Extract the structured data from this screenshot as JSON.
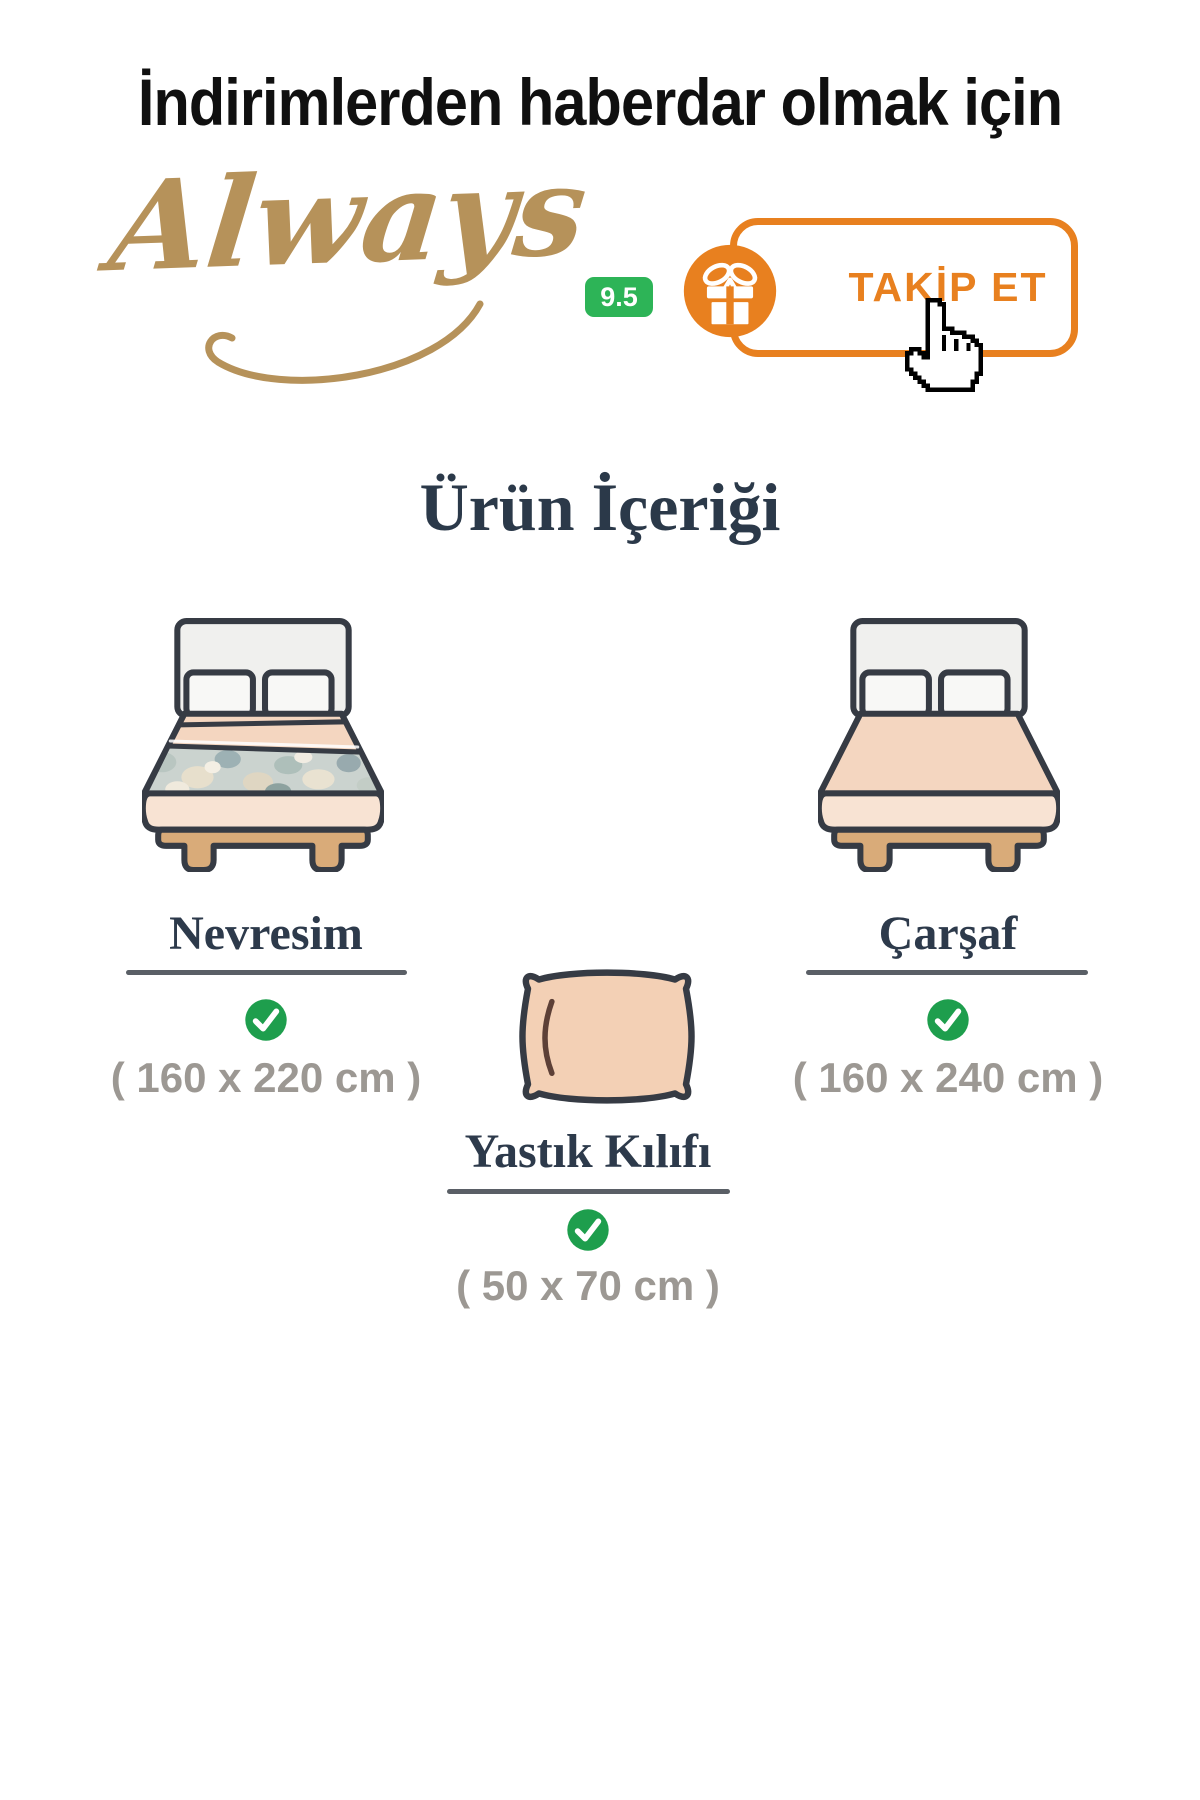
{
  "header": {
    "title": "İndirimlerden haberdar olmak için"
  },
  "seller": {
    "logo_text": "Always",
    "rating": "9.5",
    "follow_label": "TAKİP ET"
  },
  "section": {
    "title": "Ürün İçeriği"
  },
  "items": [
    {
      "name": "Nevresim",
      "included": true,
      "dimensions": "( 160 x 220 cm )"
    },
    {
      "name": "Çarşaf",
      "included": true,
      "dimensions": "( 160 x 240 cm )"
    },
    {
      "name": "Yastık Kılıfı",
      "included": true,
      "dimensions": "( 50 x 70 cm )"
    }
  ],
  "colors": {
    "accent_orange": "#e8801f",
    "rating_green": "#2db457",
    "check_green": "#1e9e4d",
    "logo_gold": "#b6925a",
    "heading_navy": "#2b3949",
    "dims_gray": "#9c9893",
    "illustration_outline": "#363b44",
    "linen_peach": "#f4d6c0",
    "wood_tan": "#d9ab79",
    "duvet_floral": "#cbd3cf"
  },
  "icons": {
    "gift": "gift-icon",
    "check": "check-circle-icon",
    "cursor": "hand-cursor-icon"
  }
}
